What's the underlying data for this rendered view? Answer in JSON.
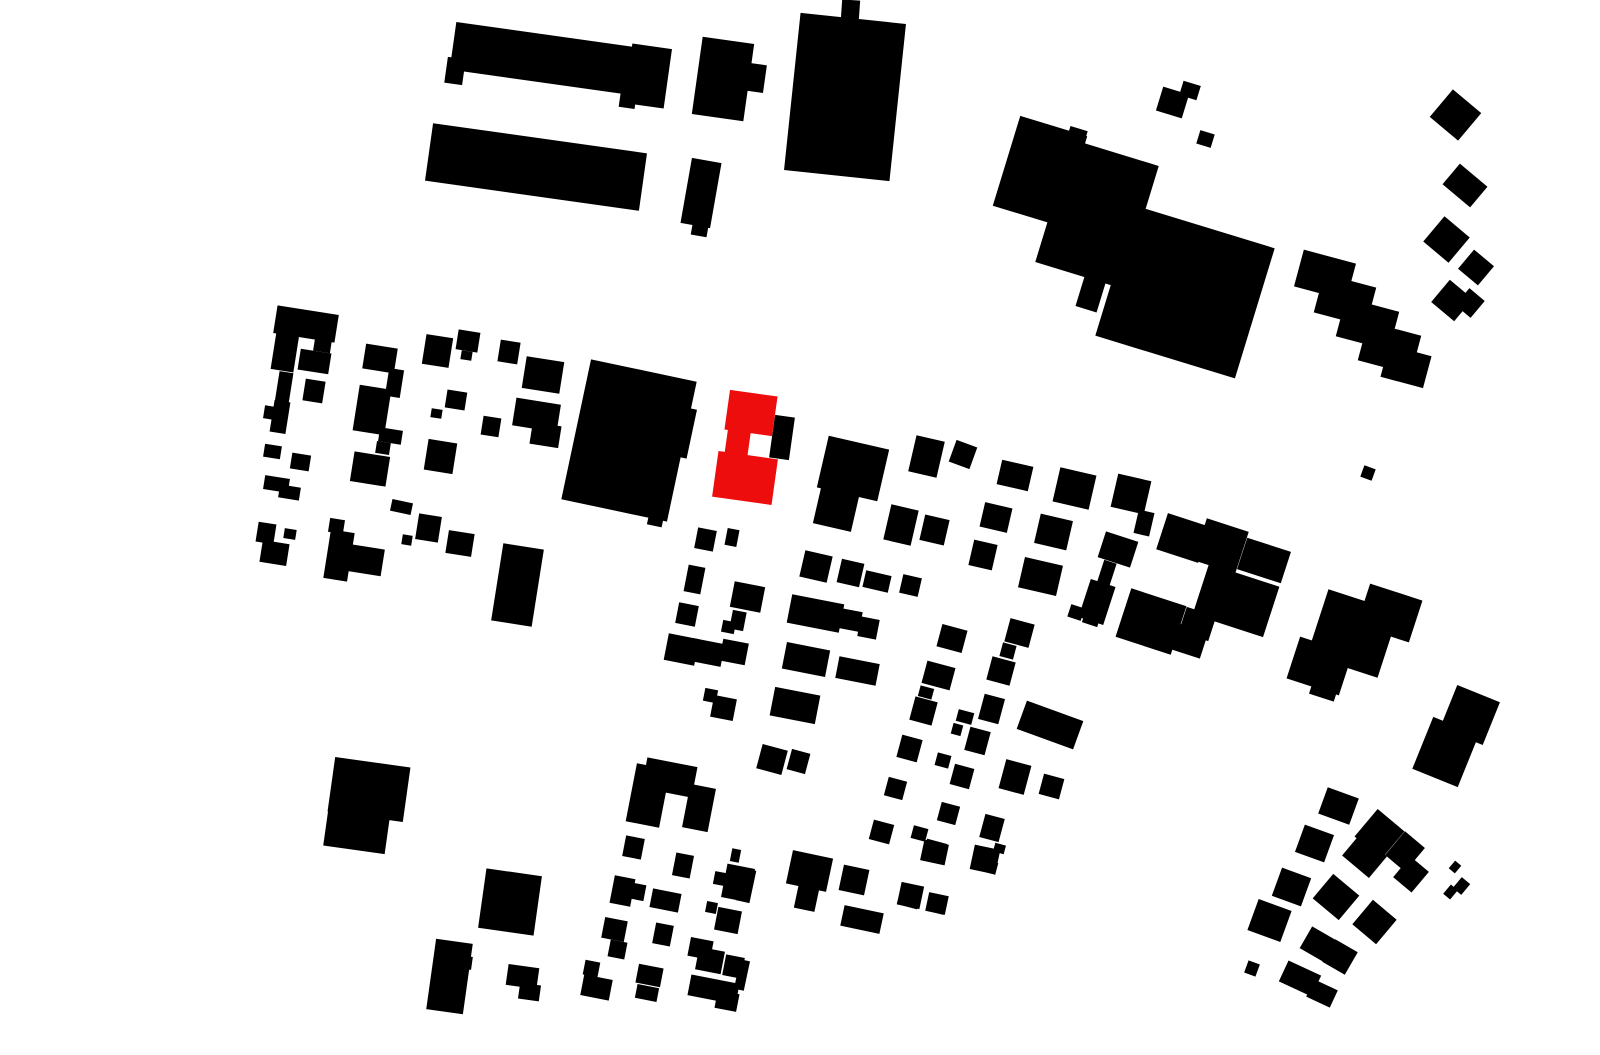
{
  "canvas": {
    "width": 1600,
    "height": 1055,
    "background": "#ffffff"
  },
  "colors": {
    "building": "#000000",
    "highlight": "#ee0d0d"
  },
  "legend": {
    "map_type": "figure-ground-site-plan",
    "highlighted_building_count": 1
  },
  "buildings": [
    [
      452,
      36,
      205,
      48,
      8
    ],
    [
      628,
      46,
      40,
      60,
      8
    ],
    [
      446,
      58,
      18,
      26,
      8
    ],
    [
      620,
      88,
      16,
      20,
      8
    ],
    [
      428,
      138,
      216,
      58,
      8
    ],
    [
      697,
      40,
      52,
      78,
      8
    ],
    [
      748,
      64,
      17,
      28,
      8
    ],
    [
      792,
      18,
      106,
      158,
      6
    ],
    [
      841,
      0,
      18,
      34,
      4
    ],
    [
      686,
      160,
      30,
      66,
      10
    ],
    [
      692,
      220,
      16,
      16,
      10
    ],
    [
      1005,
      124,
      70,
      94,
      17
    ],
    [
      1066,
      128,
      18,
      28,
      17
    ],
    [
      1052,
      150,
      90,
      128,
      17
    ],
    [
      1080,
      276,
      22,
      34,
      17
    ],
    [
      1112,
      224,
      146,
      136,
      17
    ],
    [
      1140,
      220,
      24,
      26,
      17
    ],
    [
      1158,
      246,
      20,
      18,
      17
    ],
    [
      1159,
      90,
      27,
      25,
      17
    ],
    [
      1181,
      83,
      18,
      15,
      17
    ],
    [
      1198,
      132,
      15,
      14,
      17
    ],
    [
      1437,
      97,
      37,
      36,
      40
    ],
    [
      1447,
      172,
      36,
      27,
      40
    ],
    [
      1430,
      223,
      33,
      33,
      40
    ],
    [
      1463,
      255,
      26,
      25,
      40
    ],
    [
      1437,
      286,
      30,
      29,
      40
    ],
    [
      1460,
      292,
      20,
      22,
      40
    ],
    [
      1298,
      256,
      54,
      38,
      15
    ],
    [
      1318,
      280,
      54,
      40,
      15
    ],
    [
      1340,
      304,
      55,
      40,
      15
    ],
    [
      1362,
      328,
      55,
      40,
      15
    ],
    [
      1384,
      350,
      44,
      33,
      15
    ],
    [
      275,
      310,
      62,
      28,
      9
    ],
    [
      275,
      313,
      23,
      58,
      9
    ],
    [
      314,
      339,
      17,
      13,
      9
    ],
    [
      299,
      351,
      31,
      21,
      9
    ],
    [
      277,
      372,
      14,
      32,
      9
    ],
    [
      304,
      380,
      20,
      22,
      9
    ],
    [
      272,
      401,
      16,
      32,
      9
    ],
    [
      264,
      406,
      10,
      13,
      9
    ],
    [
      264,
      445,
      17,
      13,
      9
    ],
    [
      291,
      454,
      19,
      16,
      9
    ],
    [
      264,
      477,
      25,
      14,
      9
    ],
    [
      279,
      486,
      21,
      13,
      9
    ],
    [
      257,
      523,
      18,
      20,
      9
    ],
    [
      261,
      542,
      27,
      22,
      9
    ],
    [
      284,
      529,
      12,
      10,
      9
    ],
    [
      364,
      346,
      32,
      25,
      9
    ],
    [
      356,
      387,
      32,
      46,
      9
    ],
    [
      387,
      369,
      15,
      28,
      9
    ],
    [
      379,
      429,
      23,
      14,
      9
    ],
    [
      352,
      454,
      36,
      30,
      9
    ],
    [
      376,
      442,
      14,
      12,
      9
    ],
    [
      329,
      519,
      15,
      14,
      9
    ],
    [
      327,
      531,
      24,
      49,
      9
    ],
    [
      339,
      546,
      44,
      27,
      9
    ],
    [
      391,
      501,
      21,
      12,
      12
    ],
    [
      417,
      515,
      23,
      26,
      9
    ],
    [
      402,
      535,
      10,
      10,
      9
    ],
    [
      447,
      532,
      26,
      23,
      9
    ],
    [
      424,
      336,
      27,
      30,
      9
    ],
    [
      457,
      331,
      22,
      20,
      9
    ],
    [
      461,
      351,
      11,
      9,
      9
    ],
    [
      499,
      341,
      20,
      22,
      9
    ],
    [
      524,
      359,
      38,
      32,
      9
    ],
    [
      446,
      391,
      20,
      18,
      9
    ],
    [
      431,
      409,
      11,
      9,
      9
    ],
    [
      482,
      417,
      18,
      19,
      9
    ],
    [
      514,
      401,
      45,
      28,
      9
    ],
    [
      531,
      424,
      29,
      22,
      9
    ],
    [
      426,
      441,
      29,
      31,
      9
    ],
    [
      497,
      546,
      41,
      78,
      9
    ],
    [
      575,
      369,
      108,
      143,
      12
    ],
    [
      671,
      407,
      21,
      50,
      12
    ],
    [
      648,
      514,
      15,
      12,
      12
    ],
    [
      772,
      416,
      20,
      43,
      8
    ],
    [
      822,
      442,
      62,
      53,
      13
    ],
    [
      817,
      487,
      39,
      41,
      13
    ],
    [
      912,
      438,
      29,
      37,
      13
    ],
    [
      952,
      443,
      22,
      23,
      20
    ],
    [
      999,
      463,
      32,
      25,
      13
    ],
    [
      1056,
      471,
      37,
      35,
      13
    ],
    [
      1114,
      477,
      34,
      34,
      13
    ],
    [
      1136,
      511,
      16,
      24,
      13
    ],
    [
      887,
      507,
      28,
      36,
      13
    ],
    [
      922,
      517,
      25,
      26,
      13
    ],
    [
      982,
      505,
      28,
      25,
      13
    ],
    [
      1037,
      517,
      33,
      30,
      13
    ],
    [
      971,
      542,
      24,
      26,
      13
    ],
    [
      802,
      553,
      28,
      27,
      13
    ],
    [
      839,
      561,
      23,
      24,
      13
    ],
    [
      864,
      573,
      26,
      17,
      13
    ],
    [
      901,
      576,
      19,
      19,
      13
    ],
    [
      1021,
      561,
      39,
      31,
      13
    ],
    [
      696,
      529,
      19,
      21,
      11
    ],
    [
      726,
      529,
      12,
      17,
      11
    ],
    [
      686,
      566,
      17,
      27,
      11
    ],
    [
      677,
      604,
      20,
      21,
      11
    ],
    [
      732,
      584,
      31,
      26,
      11
    ],
    [
      731,
      611,
      14,
      19,
      11
    ],
    [
      722,
      621,
      13,
      12,
      11
    ],
    [
      666,
      636,
      31,
      27,
      11
    ],
    [
      691,
      641,
      32,
      23,
      11
    ],
    [
      721,
      641,
      26,
      22,
      11
    ],
    [
      704,
      689,
      13,
      13,
      11
    ],
    [
      712,
      697,
      23,
      22,
      11
    ],
    [
      789,
      599,
      53,
      29,
      11
    ],
    [
      839,
      610,
      22,
      20,
      11
    ],
    [
      859,
      618,
      19,
      20,
      11
    ],
    [
      784,
      646,
      44,
      27,
      11
    ],
    [
      837,
      660,
      41,
      22,
      11
    ],
    [
      772,
      691,
      46,
      29,
      11
    ],
    [
      1101,
      536,
      34,
      27,
      18
    ],
    [
      1099,
      561,
      13,
      32,
      18
    ],
    [
      1084,
      582,
      26,
      40,
      18
    ],
    [
      1161,
      519,
      44,
      38,
      18
    ],
    [
      1199,
      524,
      44,
      44,
      18
    ],
    [
      1241,
      544,
      46,
      33,
      18
    ],
    [
      1199,
      574,
      74,
      53,
      18
    ],
    [
      1122,
      596,
      58,
      51,
      18
    ],
    [
      1164,
      626,
      41,
      27,
      18
    ],
    [
      1182,
      611,
      31,
      26,
      18
    ],
    [
      1069,
      606,
      14,
      13,
      18
    ],
    [
      1084,
      609,
      16,
      16,
      18
    ],
    [
      1316,
      599,
      74,
      69,
      18
    ],
    [
      1362,
      591,
      55,
      44,
      18
    ],
    [
      1292,
      644,
      55,
      44,
      18
    ],
    [
      1311,
      681,
      26,
      17,
      18
    ],
    [
      1447,
      692,
      46,
      46,
      22
    ],
    [
      1421,
      724,
      49,
      56,
      22
    ],
    [
      939,
      627,
      26,
      23,
      15
    ],
    [
      1007,
      621,
      25,
      24,
      15
    ],
    [
      1001,
      644,
      14,
      14,
      15
    ],
    [
      989,
      659,
      24,
      24,
      15
    ],
    [
      924,
      664,
      29,
      23,
      15
    ],
    [
      919,
      687,
      14,
      11,
      15
    ],
    [
      912,
      699,
      23,
      24,
      15
    ],
    [
      981,
      696,
      21,
      26,
      15
    ],
    [
      957,
      711,
      16,
      12,
      15
    ],
    [
      952,
      724,
      10,
      11,
      15
    ],
    [
      967,
      729,
      21,
      24,
      15
    ],
    [
      1020,
      710,
      60,
      30,
      20
    ],
    [
      899,
      737,
      21,
      23,
      15
    ],
    [
      936,
      754,
      14,
      13,
      15
    ],
    [
      952,
      766,
      20,
      21,
      15
    ],
    [
      1002,
      762,
      26,
      30,
      15
    ],
    [
      1041,
      776,
      21,
      21,
      15
    ],
    [
      886,
      779,
      19,
      19,
      15
    ],
    [
      939,
      804,
      19,
      19,
      15
    ],
    [
      871,
      822,
      21,
      20,
      15
    ],
    [
      912,
      827,
      15,
      13,
      15
    ],
    [
      982,
      816,
      20,
      24,
      15
    ],
    [
      924,
      841,
      21,
      21,
      15
    ],
    [
      994,
      844,
      11,
      9,
      15
    ],
    [
      974,
      851,
      19,
      12,
      15
    ],
    [
      982,
      861,
      15,
      12,
      15
    ],
    [
      899,
      887,
      21,
      20,
      15
    ],
    [
      929,
      901,
      16,
      12,
      15
    ],
    [
      331,
      762,
      76,
      55,
      8
    ],
    [
      326,
      806,
      62,
      44,
      8
    ],
    [
      482,
      872,
      56,
      60,
      8
    ],
    [
      431,
      941,
      37,
      71,
      8
    ],
    [
      459,
      956,
      13,
      13,
      8
    ],
    [
      450,
      994,
      12,
      12,
      8
    ],
    [
      507,
      966,
      31,
      21,
      8
    ],
    [
      519,
      984,
      21,
      16,
      8
    ],
    [
      631,
      766,
      34,
      59,
      11
    ],
    [
      644,
      762,
      51,
      31,
      11
    ],
    [
      686,
      786,
      26,
      44,
      11
    ],
    [
      624,
      837,
      19,
      21,
      11
    ],
    [
      674,
      854,
      18,
      23,
      11
    ],
    [
      731,
      849,
      9,
      13,
      11
    ],
    [
      724,
      866,
      28,
      34,
      11
    ],
    [
      714,
      872,
      11,
      13,
      11
    ],
    [
      612,
      877,
      21,
      28,
      11
    ],
    [
      632,
      884,
      13,
      16,
      11
    ],
    [
      651,
      891,
      29,
      19,
      11
    ],
    [
      706,
      902,
      11,
      11,
      11
    ],
    [
      716,
      909,
      24,
      23,
      11
    ],
    [
      603,
      919,
      23,
      21,
      11
    ],
    [
      609,
      941,
      17,
      17,
      11
    ],
    [
      654,
      924,
      18,
      21,
      11
    ],
    [
      689,
      939,
      23,
      19,
      11
    ],
    [
      697,
      949,
      26,
      23,
      11
    ],
    [
      724,
      956,
      19,
      21,
      11
    ],
    [
      584,
      961,
      15,
      15,
      11
    ],
    [
      582,
      977,
      29,
      21,
      11
    ],
    [
      637,
      966,
      25,
      19,
      11
    ],
    [
      636,
      986,
      22,
      14,
      11
    ],
    [
      689,
      979,
      49,
      21,
      11
    ],
    [
      716,
      992,
      22,
      18,
      11
    ],
    [
      759,
      747,
      26,
      25,
      15
    ],
    [
      789,
      751,
      19,
      21,
      15
    ],
    [
      789,
      854,
      41,
      34,
      12
    ],
    [
      796,
      887,
      21,
      23,
      12
    ],
    [
      841,
      867,
      26,
      26,
      12
    ],
    [
      842,
      909,
      40,
      21,
      12
    ],
    [
      899,
      884,
      23,
      23,
      12
    ],
    [
      927,
      894,
      20,
      19,
      12
    ],
    [
      922,
      842,
      25,
      21,
      12
    ],
    [
      972,
      847,
      26,
      25,
      12
    ],
    [
      739,
      869,
      14,
      33,
      12
    ],
    [
      737,
      960,
      10,
      30,
      12
    ],
    [
      1322,
      792,
      33,
      28,
      20
    ],
    [
      1299,
      829,
      31,
      29,
      20
    ],
    [
      1362,
      816,
      35,
      36,
      40
    ],
    [
      1347,
      842,
      35,
      28,
      40
    ],
    [
      1392,
      836,
      26,
      31,
      40
    ],
    [
      1399,
      861,
      24,
      27,
      40
    ],
    [
      1451,
      862,
      8,
      10,
      40
    ],
    [
      1446,
      886,
      9,
      12,
      40
    ],
    [
      1456,
      879,
      11,
      14,
      40
    ],
    [
      1276,
      872,
      31,
      30,
      20
    ],
    [
      1319,
      881,
      34,
      32,
      40
    ],
    [
      1252,
      904,
      35,
      33,
      20
    ],
    [
      1359,
      906,
      31,
      32,
      40
    ],
    [
      1304,
      932,
      29,
      25,
      30
    ],
    [
      1327,
      944,
      26,
      26,
      30
    ],
    [
      1246,
      962,
      12,
      13,
      20
    ],
    [
      1282,
      967,
      36,
      23,
      25
    ],
    [
      1309,
      984,
      26,
      19,
      25
    ],
    [
      1362,
      467,
      12,
      12,
      20
    ]
  ],
  "highlight_buildings": [
    [
      727,
      393,
      48,
      40,
      8
    ],
    [
      726,
      429,
      23,
      30,
      8
    ],
    [
      715,
      455,
      60,
      46,
      8
    ]
  ]
}
